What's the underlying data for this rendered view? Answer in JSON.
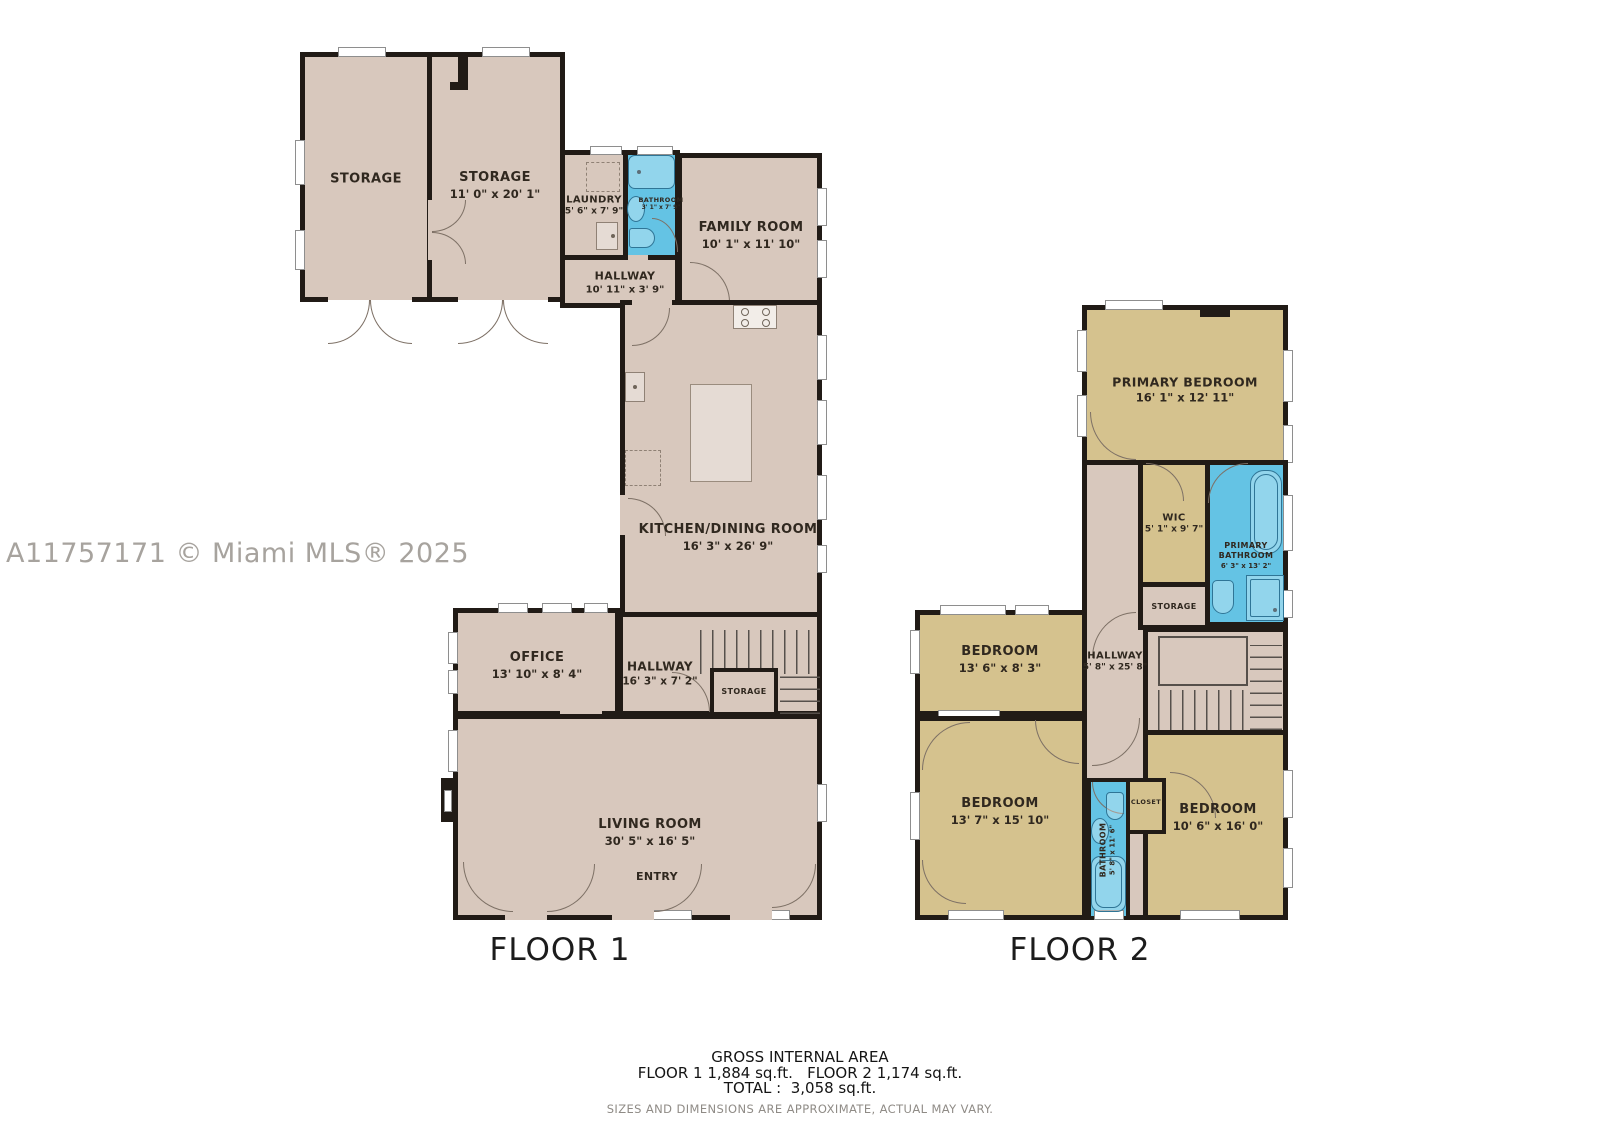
{
  "watermark": "A11757171 © Miami MLS® 2025",
  "colors": {
    "wall": "#211b16",
    "floor1_room": "#d8c8bd",
    "floor2_room": "#d5c28e",
    "bathroom_fill": "#64c3e4",
    "background": "#ffffff",
    "label_text": "#30281f",
    "muted_text": "#8f8b86"
  },
  "floor1": {
    "label": "FLOOR 1",
    "rooms": {
      "storage_left": {
        "name": "STORAGE",
        "dims": ""
      },
      "storage_right": {
        "name": "STORAGE",
        "dims": "11' 0\" x 20' 1\""
      },
      "laundry": {
        "name": "LAUNDRY",
        "dims": "5' 6\" x 7' 9\""
      },
      "bathroom": {
        "name": "BATHROOM",
        "dims": "3' 1\" x 7' 9\""
      },
      "family_room": {
        "name": "FAMILY ROOM",
        "dims": "10' 1\" x 11' 10\""
      },
      "hallway_upper": {
        "name": "HALLWAY",
        "dims": "10' 11\" x 3' 9\""
      },
      "kitchen_dining": {
        "name": "KITCHEN/DINING ROOM",
        "dims": "16' 3\" x 26' 9\""
      },
      "office": {
        "name": "OFFICE",
        "dims": "13' 10\" x 8' 4\""
      },
      "hallway_lower": {
        "name": "HALLWAY",
        "dims": "16' 3\" x 7' 2\""
      },
      "storage_under_stairs": {
        "name": "STORAGE",
        "dims": ""
      },
      "living_room": {
        "name": "LIVING ROOM",
        "dims": "30' 5\" x 16' 5\""
      },
      "entry": {
        "name": "ENTRY",
        "dims": ""
      }
    }
  },
  "floor2": {
    "label": "FLOOR 2",
    "rooms": {
      "primary_bedroom": {
        "name": "PRIMARY BEDROOM",
        "dims": "16' 1\" x 12' 11\""
      },
      "wic": {
        "name": "WIC",
        "dims": "5' 1\" x 9' 7\""
      },
      "primary_bathroom": {
        "name": "PRIMARY BATHROOM",
        "dims": "6' 3\" x 13' 2\""
      },
      "storage": {
        "name": "STORAGE",
        "dims": ""
      },
      "hallway": {
        "name": "HALLWAY",
        "dims": "5' 8\" x 25' 8\""
      },
      "bedroom_top": {
        "name": "BEDROOM",
        "dims": "13' 6\" x 8' 3\""
      },
      "bedroom_left": {
        "name": "BEDROOM",
        "dims": "13' 7\" x 15' 10\""
      },
      "bathroom": {
        "name": "BATHROOM",
        "dims": "5' 8\" x 11' 6\""
      },
      "closet": {
        "name": "CLOSET",
        "dims": ""
      },
      "bedroom_right": {
        "name": "BEDROOM",
        "dims": "10' 6\" x 16' 0\""
      }
    }
  },
  "footer": {
    "title": "GROSS INTERNAL AREA",
    "areas_line": "FLOOR 1 1,884 sq.ft.   FLOOR 2 1,174 sq.ft.",
    "total_line": "TOTAL :  3,058 sq.ft.",
    "disclaimer": "SIZES AND DIMENSIONS ARE APPROXIMATE, ACTUAL MAY VARY."
  }
}
